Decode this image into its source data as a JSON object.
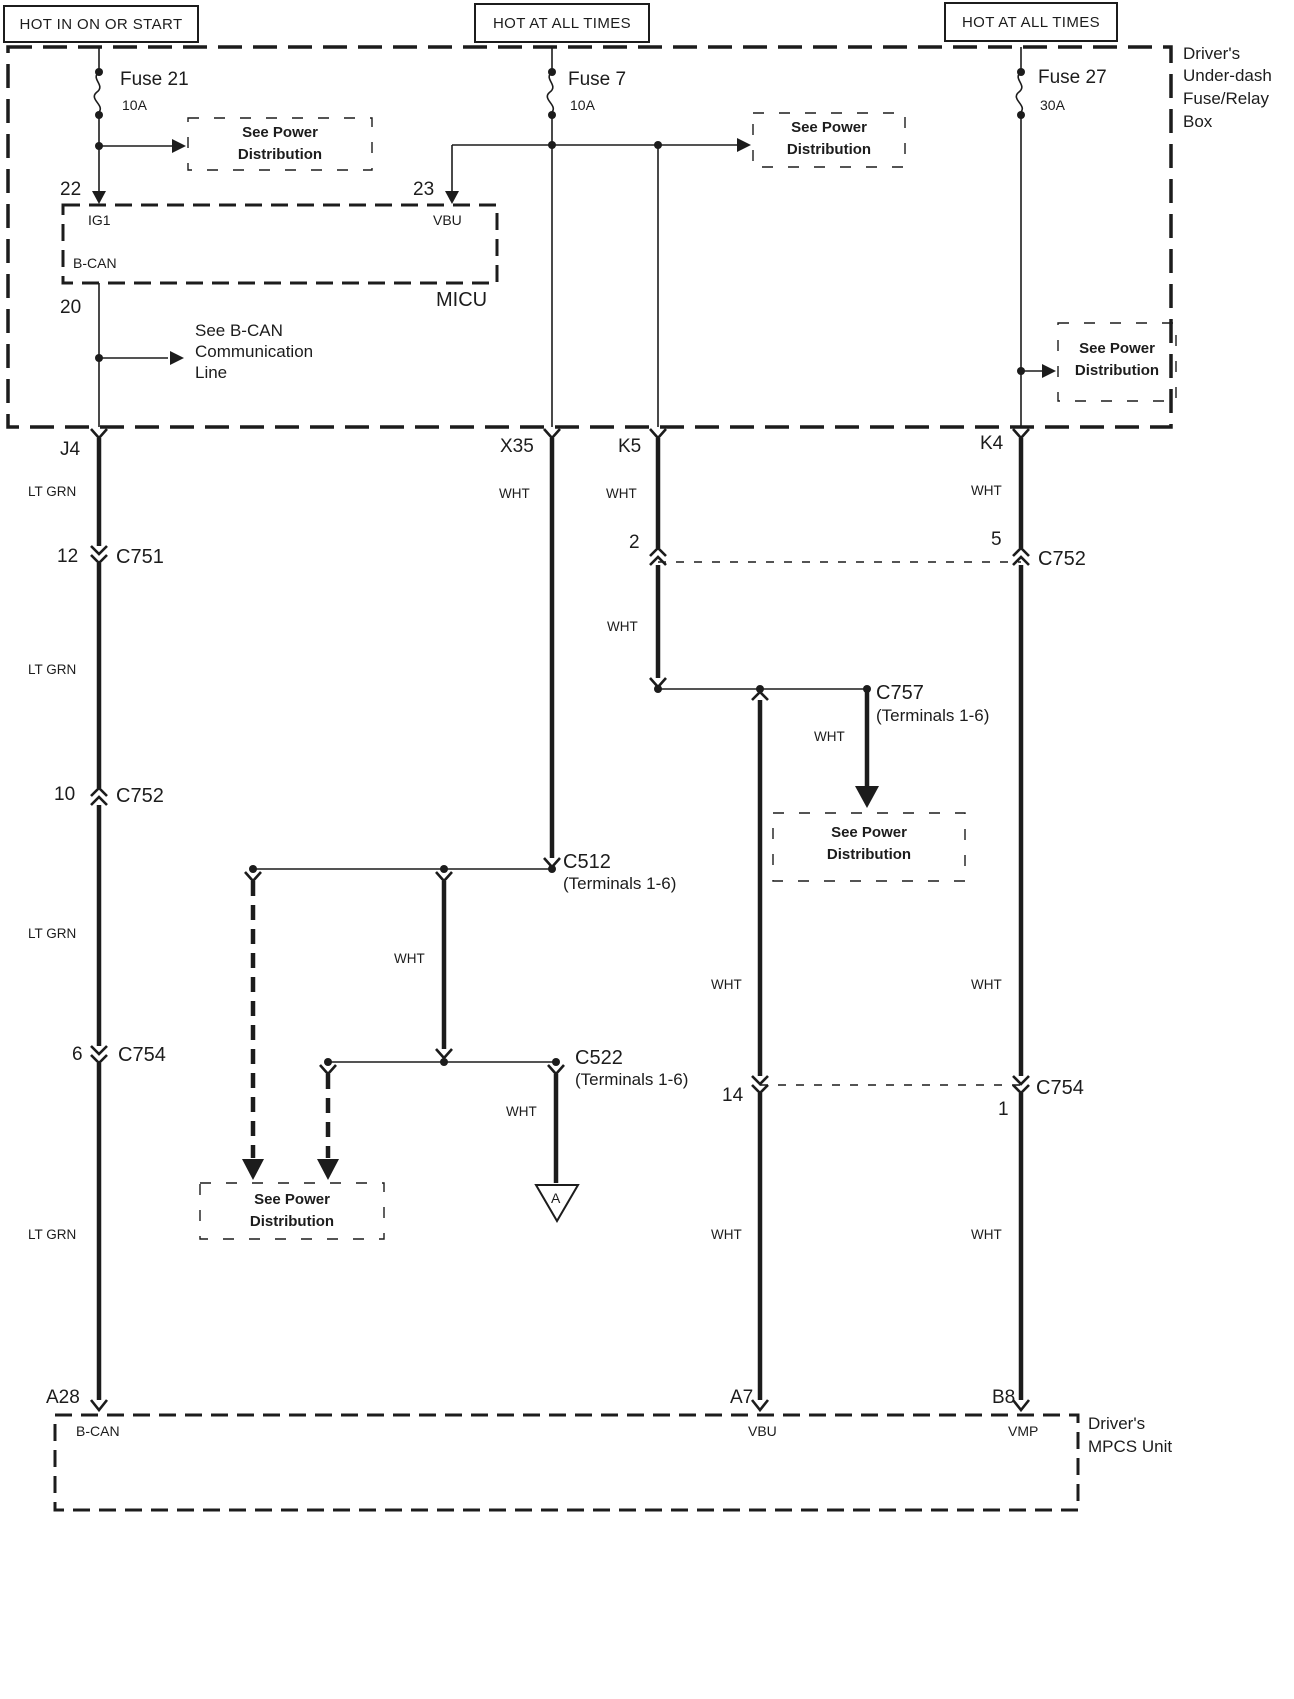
{
  "header": {
    "hot_left": "HOT IN ON OR START",
    "hot_mid": "HOT AT ALL TIMES",
    "hot_right": "HOT AT ALL TIMES"
  },
  "fuse_box": {
    "name_line1": "Driver's",
    "name_line2": "Under-dash",
    "name_line3": "Fuse/Relay",
    "name_line4": "Box"
  },
  "fuses": {
    "f21": {
      "name": "Fuse 21",
      "rating": "10A"
    },
    "f7": {
      "name": "Fuse 7",
      "rating": "10A"
    },
    "f27": {
      "name": "Fuse 27",
      "rating": "30A"
    }
  },
  "micu": {
    "name": "MICU",
    "pin_ig1": "IG1",
    "pin_vbu": "VBU",
    "pin_bcan": "B-CAN",
    "term_22": "22",
    "term_23": "23",
    "term_20": "20"
  },
  "notes": {
    "spd_line1": "See Power",
    "spd_line2": "Distribution",
    "bcan_line1": "See B-CAN",
    "bcan_line2": "Communication",
    "bcan_line3": "Line"
  },
  "connectors": {
    "j4": "J4",
    "x35": "X35",
    "k5": "K5",
    "k4": "K4",
    "c751": "C751",
    "c752": "C752",
    "c754": "C754",
    "c757": "C757",
    "c512": "C512",
    "c522": "C522",
    "terminals_1_6": "(Terminals 1-6)",
    "t12": "12",
    "t10": "10",
    "t6": "6",
    "t2": "2",
    "t5": "5",
    "t14": "14",
    "t1": "1"
  },
  "wire_colors": {
    "lt_grn": "LT GRN",
    "wht": "WHT"
  },
  "mpcs": {
    "name_line1": "Driver's",
    "name_line2": "MPCS Unit",
    "term_a28": "A28",
    "term_a7": "A7",
    "term_b8": "B8",
    "pin_bcan": "B-CAN",
    "pin_vbu": "VBU",
    "pin_vmp": "VMP"
  },
  "symbols": {
    "triangle_a": "A"
  },
  "colors": {
    "ink": "#1c1c1c",
    "background": "#ffffff"
  }
}
